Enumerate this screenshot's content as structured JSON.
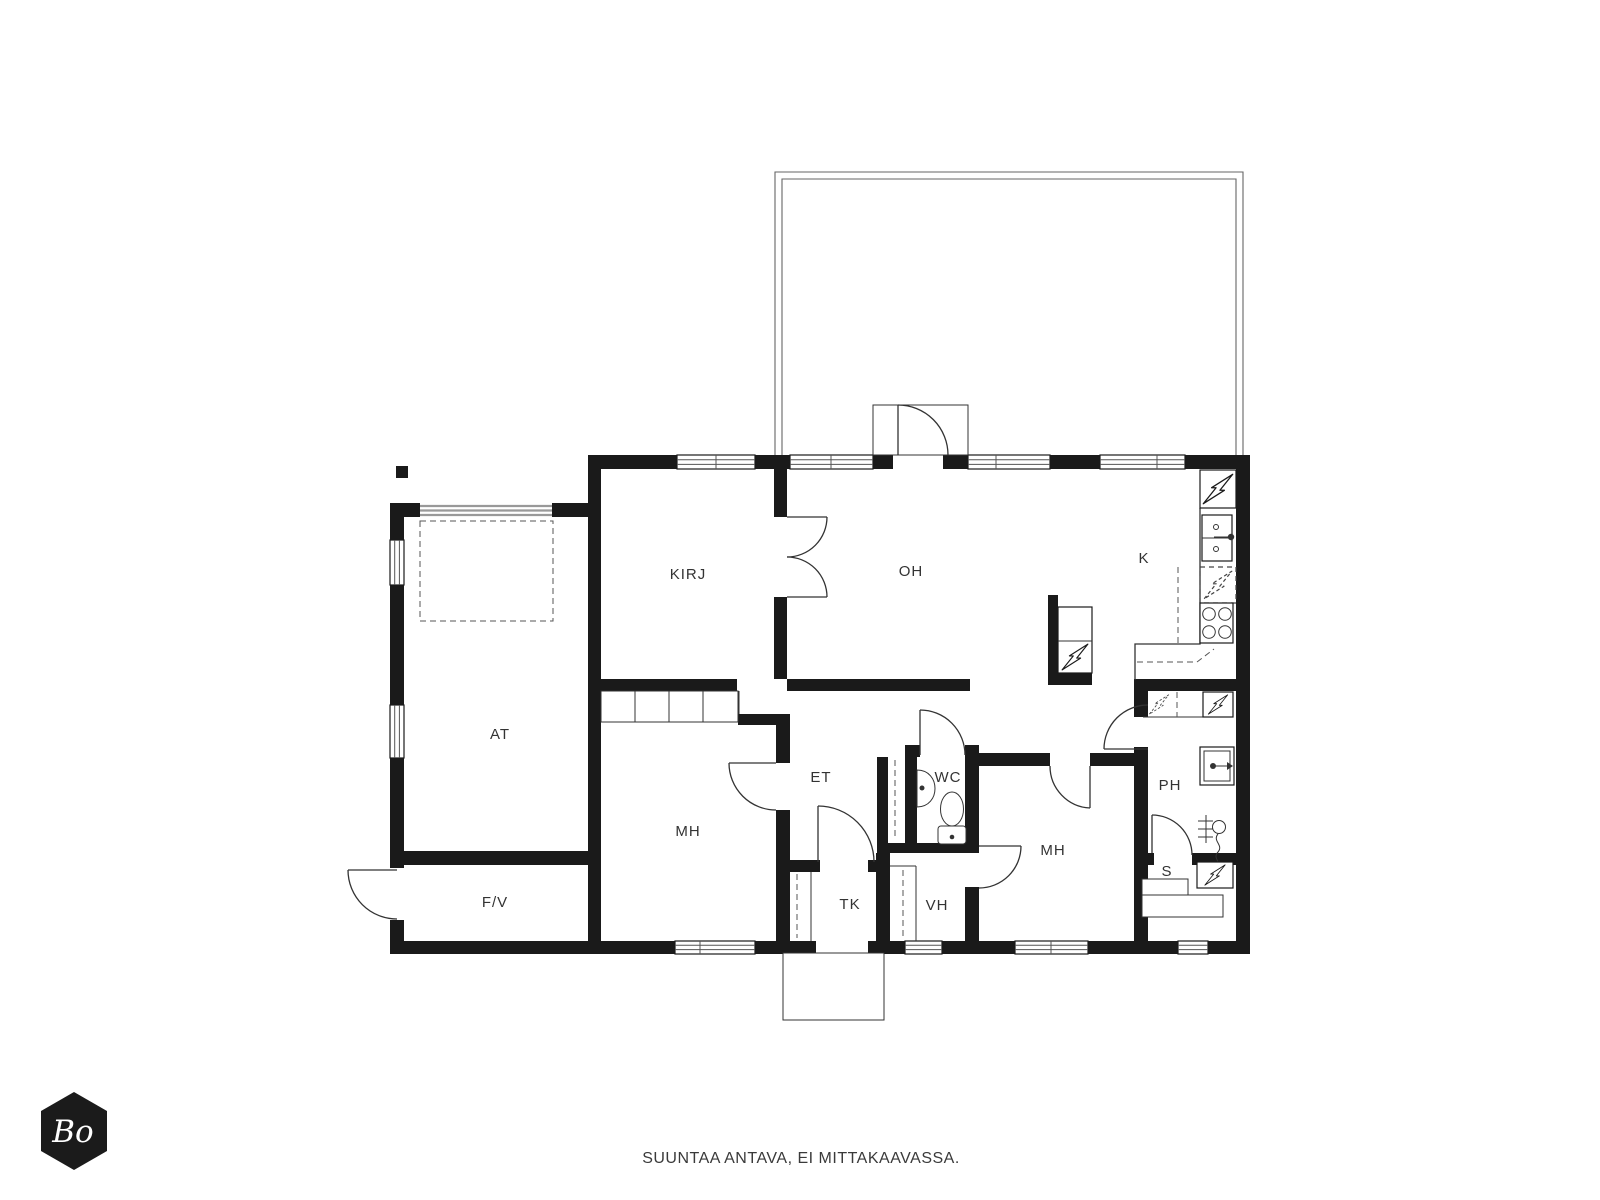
{
  "title": "Floor plan",
  "rooms": [
    {
      "id": "at",
      "label": "AT"
    },
    {
      "id": "kirj",
      "label": "KIRJ"
    },
    {
      "id": "oh",
      "label": "OH"
    },
    {
      "id": "k",
      "label": "K"
    },
    {
      "id": "mh1",
      "label": "MH"
    },
    {
      "id": "et",
      "label": "ET"
    },
    {
      "id": "wc",
      "label": "WC"
    },
    {
      "id": "mh2",
      "label": "MH"
    },
    {
      "id": "ph",
      "label": "PH"
    },
    {
      "id": "s",
      "label": "S"
    },
    {
      "id": "tk",
      "label": "TK"
    },
    {
      "id": "vh",
      "label": "VH"
    },
    {
      "id": "fv",
      "label": "F/V"
    }
  ],
  "logo": {
    "text": "Bo"
  },
  "footer": {
    "disclaimer": "SUUNTAA ANTAVA, EI MITTAKAAVASSA."
  },
  "icons": {
    "lightning-bolt": "electric appliance",
    "dashed-lightning-bolt": "reserved appliance slot",
    "door-arc": "door swing",
    "kitchen-sink": "double basin sink",
    "stove": "four burner stove",
    "toilet": "wc toilet seat",
    "wc-sink": "hand basin",
    "washing-machine": "washing machine",
    "shower": "shower",
    "sauna-heater": "sauna stove",
    "sauna-bench": "sauna benches",
    "fireplace": "fireplace / flue block"
  },
  "colors": {
    "wall": "#1a1a1a",
    "line": "#333333",
    "window_line": "#555555",
    "garage_door": "#999999",
    "terrace_line": "#666666",
    "logo_bg": "#1b1b1b",
    "text": "#3a3a3a",
    "background": "#ffffff"
  }
}
